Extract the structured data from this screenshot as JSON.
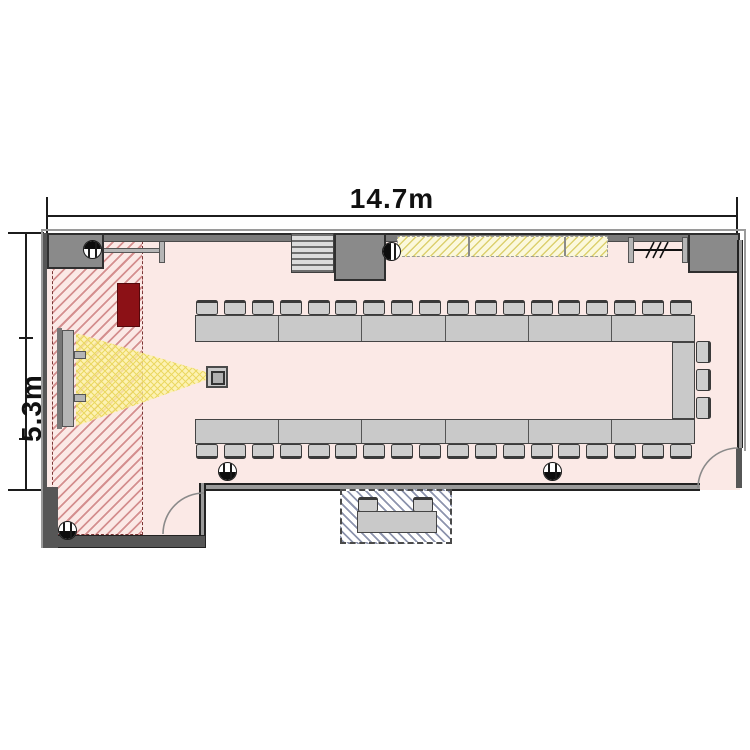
{
  "plan": {
    "type": "floor-plan",
    "room_name": "seminar-room",
    "dimensions": {
      "width_label": "14.7m",
      "depth_label": "5.3m"
    }
  },
  "colors": {
    "floor": "#fbe9e6",
    "hatch_line": "#d48f8f",
    "red_cabinet": "#8c1116",
    "table": "#c9c9c9",
    "chair": "#cdcdcd",
    "board_fill": "#fbf8dc",
    "board_line": "#dcd06e",
    "beam_fill": "#fdf4a3",
    "beam_line": "#e8d455",
    "annex_line": "#8d94ad",
    "wall_fill": "#8a8a8a"
  },
  "seating": {
    "top_row": {
      "chairs": 18,
      "table_segments": 6
    },
    "bottom_row": {
      "chairs": 18,
      "table_segments": 6
    },
    "right_column": {
      "chairs": 3,
      "table_segments": 1
    },
    "annex": {
      "chairs": 2,
      "table_segments": 1
    }
  },
  "equipment": {
    "screen": "projection-screen",
    "projector": "projector-on-stand",
    "cabinet": "red-cabinet",
    "board": "hatched-wall-board",
    "rack": "striped-rack",
    "partition_mark": "///",
    "doors": 2,
    "fixture_symbols": 5
  }
}
